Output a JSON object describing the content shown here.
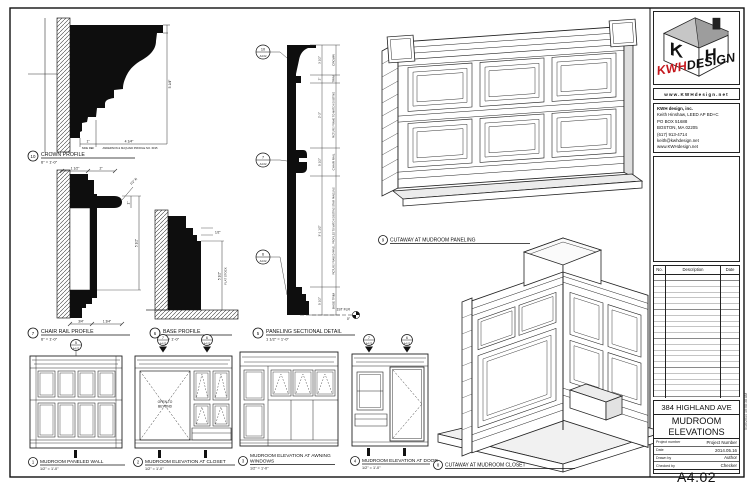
{
  "title_block": {
    "logo": {
      "kwh": "KWH",
      "design": "DESIGN",
      "website": "www.KWHdesign.net"
    },
    "firm_lines": [
      "KWH design, inc.",
      "Keith Hinshaw, LEED AP BD+C",
      "PO BOX 51688",
      "BOSTON, MA 02205",
      "(617) 913-4714",
      "keith@kwhdesign.net",
      "www.KWHdesign.net"
    ],
    "revisions": {
      "no": "No.",
      "description": "Description",
      "date": "Date"
    },
    "project": {
      "address": "384 HIGHLAND AVE",
      "title1": "MUDROOM",
      "title2": "ELEVATIONS",
      "fields": [
        {
          "label": "Project number",
          "value": "Project Number"
        },
        {
          "label": "Date",
          "value": "2014.05.16"
        },
        {
          "label": "Drawn by",
          "value": "Author"
        },
        {
          "label": "Checked by",
          "value": "Checker"
        }
      ],
      "sheet_number": "A4.02",
      "scale_label": "Scale",
      "scale_value": "As indicated"
    },
    "plot_stamp": "5/16/2014 10:08:38 AM"
  },
  "details": {
    "crown": {
      "num": "10",
      "title": "CROWN PROFILE",
      "scale": "6\" = 1'-0\""
    },
    "chair_rail": {
      "num": "7",
      "title": "CHAIR RAIL PROFILE",
      "scale": "6\" = 1'-0\""
    },
    "base": {
      "num": "6",
      "title": "BASE PROFILE",
      "scale": "6\" = 1'-0\""
    },
    "paneling_section": {
      "num": "5",
      "title": "PANELING SECTIONAL DETAIL",
      "scale": "1 1/2\" = 1'-0\""
    },
    "cutaway_paneling": {
      "num": "9",
      "title": "CUTAWAY AT MUDROOM PANELING"
    },
    "cutaway_closet": {
      "num": "8",
      "title": "CUTAWAY AT MUDROOM CLOSET"
    },
    "paneled_wall": {
      "num": "1",
      "title": "MUDROOM PANELED WALL",
      "scale": "1/2\" = 1'-0\""
    },
    "elev_closet": {
      "num": "2",
      "title": "MUDROOM ELEVATION AT CLOSET",
      "scale": "1/2\" = 1'-0\""
    },
    "elev_awning": {
      "num": "3",
      "title1": "MUDROOM ELEVATION AT AWNING",
      "title2": "WINDOWS",
      "scale": "1/2\" = 1'-0\""
    },
    "elev_door": {
      "num": "4",
      "title": "MUDROOM ELEVATION AT DOOR",
      "scale": "1/2\" = 1'-0\""
    }
  },
  "anno": {
    "crown": {
      "dim_1": "1\"",
      "dim_4q": "4 1/4\"",
      "note_side": "SIDE REF",
      "note_profile": "ANDERSON & McQUAID PROFILE NO. 6195",
      "dim_v": "5 1/4\"",
      "dim_b1": "1 1/2\"",
      "dim_b2": "2\""
    },
    "chair": {
      "dim_r": "1/2\" R",
      "dim_1": "1\"",
      "dim_55": "5 1/2\"",
      "dim_b1": "3/4\"",
      "dim_b2": "1 3/4\""
    },
    "base": {
      "dim_half": "1/2\"",
      "dim_55": "5 1/2\"",
      "note": "FLAT STOCK"
    },
    "section": {
      "seg_names": [
        "CROWN",
        "TRIM",
        "PICTURE FRAME TO MATCH EXISTING",
        "CHAIR RAIL",
        "PICTURE FRAMED PANEL, PROFILES TO MATCH EXISTING STAIR PANELING",
        "BASE TRIM"
      ],
      "seg_dims": [
        "3 1/2\"",
        "2\"",
        "2'-2\"",
        "5 1/2\"",
        "3'-1 1/2\"",
        "5 1/2\""
      ],
      "level_name": "1ST FLR",
      "level_elev": "0\"",
      "callout_nums": [
        "10",
        "7",
        "6"
      ],
      "sheet": "A4.02"
    },
    "closet": {
      "open1": "OPEN TO",
      "open2": "BEYOND"
    },
    "markers": {
      "sheet": "A4.02",
      "e1": "5",
      "e2a": "7",
      "e2b": "6",
      "e4a": "7",
      "e4b": "6"
    }
  }
}
